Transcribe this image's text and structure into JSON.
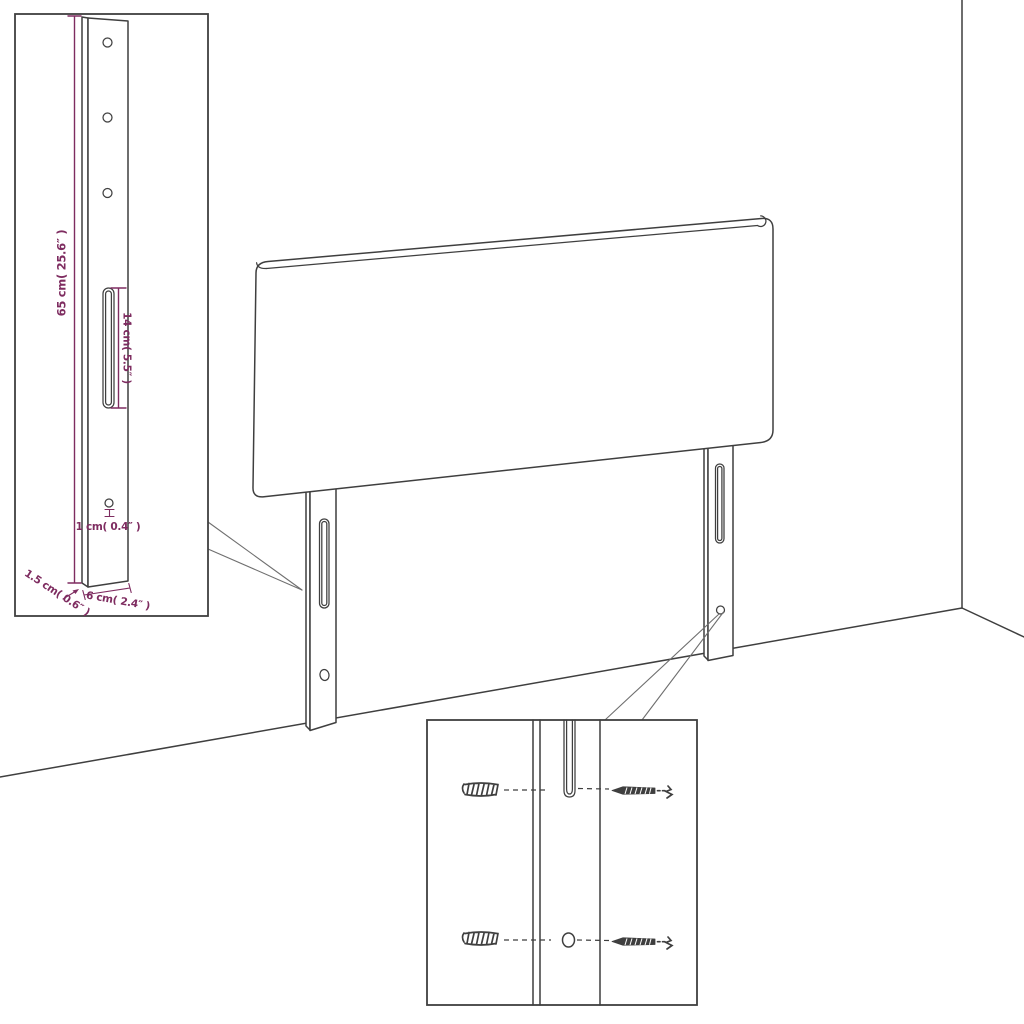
{
  "diagram": {
    "colors": {
      "line": "#3f3f3f",
      "dimension": "#7e2c60",
      "callout": "#6f6f6f",
      "background": "#ffffff"
    },
    "leg_detail_inset": {
      "labels": {
        "height": "65 cm( 25.6″ )",
        "slot_length": "14 cm( 5.5″ )",
        "hole_diameter": "1 cm( 0.4″ )",
        "thickness": "1.5 cm( 0.6″ )",
        "width": "6 cm( 2.4″ )"
      }
    }
  }
}
